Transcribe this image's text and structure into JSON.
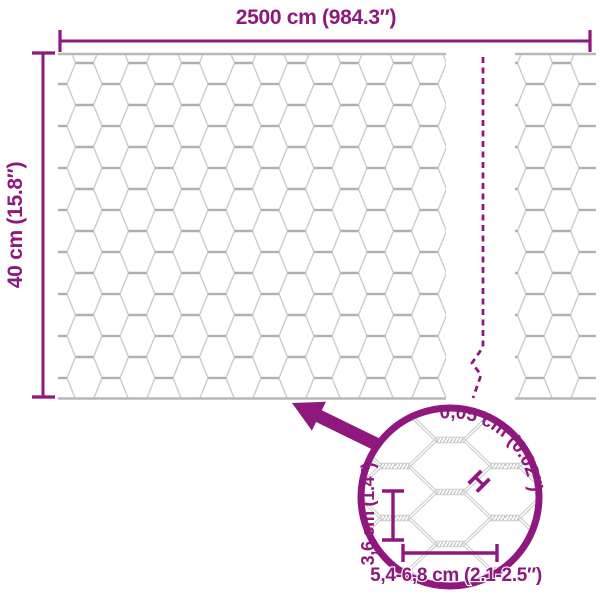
{
  "colors": {
    "accent": "#8e187e",
    "mesh_line": "#c9cccb",
    "mesh_twist": "#aeb1b0",
    "mesh_edge": "#b7bab9",
    "background": "#ffffff"
  },
  "dimensions": {
    "width_label": "2500 cm (984.3″)",
    "height_label": "40 cm (15.8″)"
  },
  "zoom_detail": {
    "wire_thickness_label": "0,05 cm (0.02″)",
    "wire_marker_glyph": "H",
    "mesh_height_label": "3,6 cm (1.4″)",
    "mesh_width_label": "5,4-6,8 cm (2.1-2.5″)"
  }
}
